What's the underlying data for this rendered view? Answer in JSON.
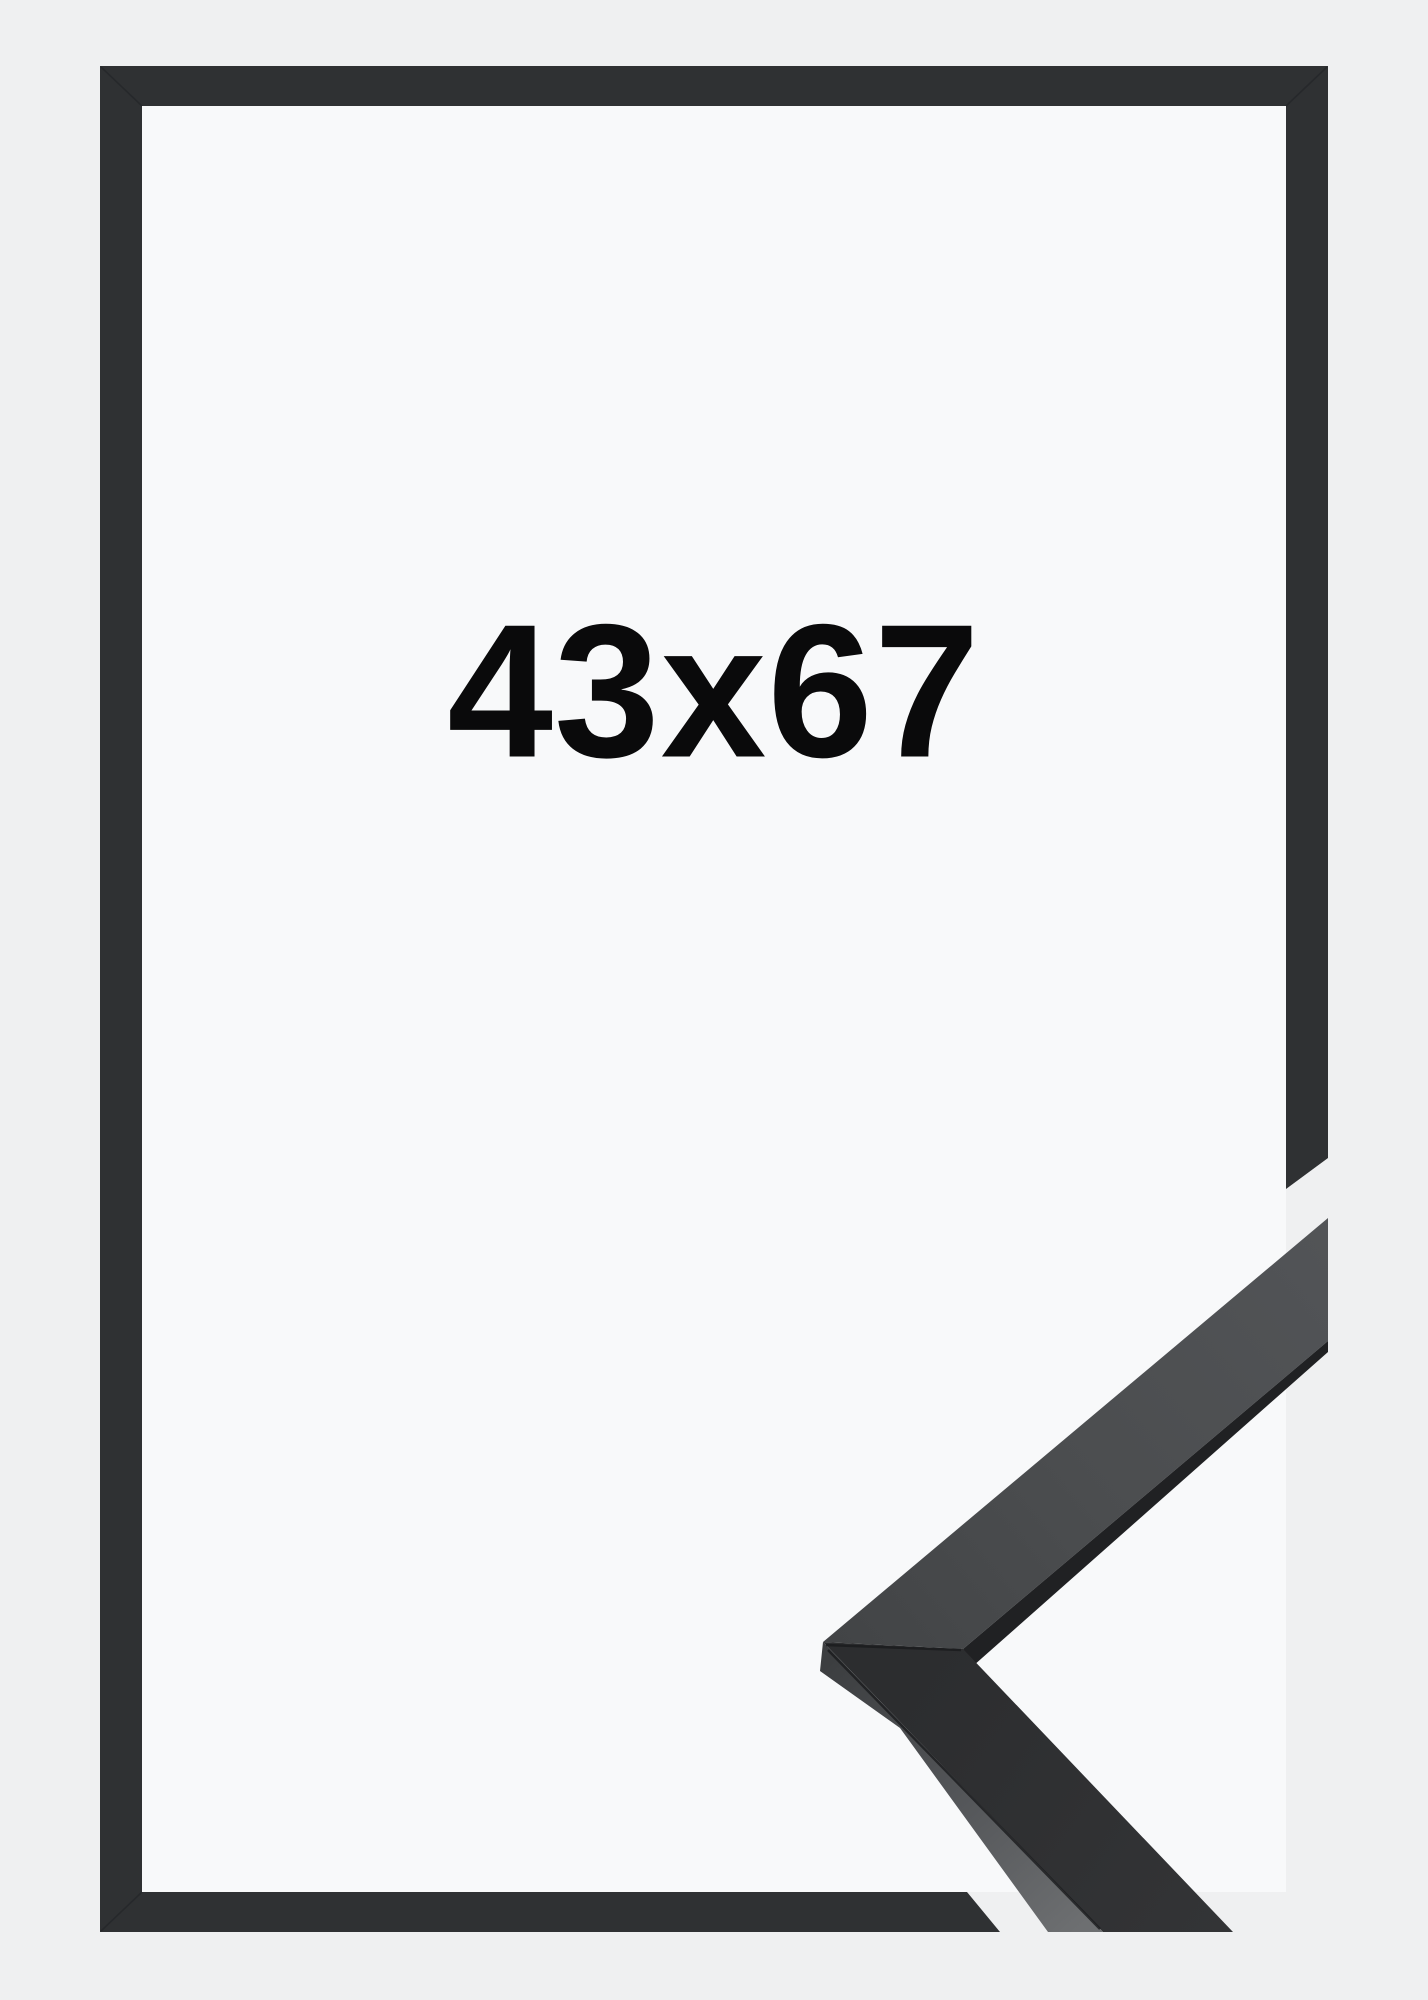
{
  "product_image": {
    "size_label": "43x67",
    "subject": "black-picture-frame-with-corner-profile-sample"
  },
  "colors": {
    "bg_outer": "#eff0f1",
    "bg_inner": "#f8f9fa",
    "frame": "#2f3133",
    "label": "#0a0a0b",
    "sample_top_face": "#4b4d4f",
    "sample_front_face": "#2c2d2f",
    "sample_side_light": "#6d6f71",
    "sample_dark_edge": "#202123"
  }
}
